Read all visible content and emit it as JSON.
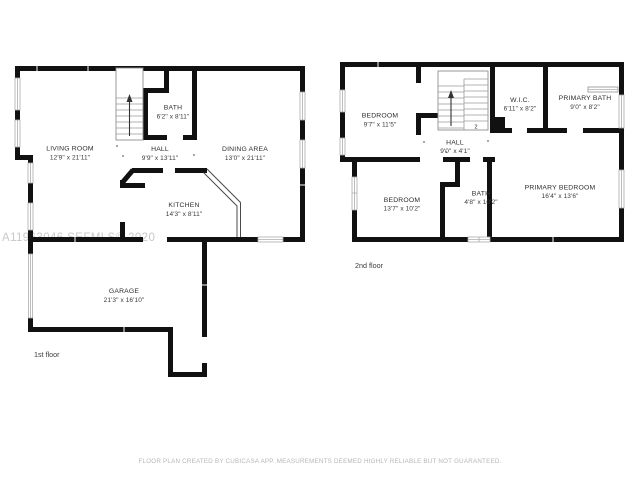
{
  "watermark": "A11963046 SEFMLS© 2020",
  "disclaimer": "FLOOR PLAN CREATED BY CUBICASA APP. MEASUREMENTS DEEMED HIGHLY RELIABLE BUT NOT GUARANTEED.",
  "stair_marker": "2",
  "colors": {
    "wall": "#111111",
    "window_frame": "#ababab",
    "watermark_text": "#c8c8c8",
    "fine_print": "#b6b6b6"
  },
  "floors": [
    {
      "label": "1st floor",
      "rooms": [
        {
          "name": "LIVING ROOM",
          "dims": "12'9\" x 21'11\""
        },
        {
          "name": "BATH",
          "dims": "6'2\" x 8'11\""
        },
        {
          "name": "HALL",
          "dims": "9'9\" x 13'11\""
        },
        {
          "name": "DINING AREA",
          "dims": "13'0\" x 21'11\""
        },
        {
          "name": "KITCHEN",
          "dims": "14'3\" x 8'11\""
        },
        {
          "name": "GARAGE",
          "dims": "21'3\" x 16'10\""
        }
      ]
    },
    {
      "label": "2nd floor",
      "rooms": [
        {
          "name": "BEDROOM",
          "dims": "9'7\" x 11'5\""
        },
        {
          "name": "W.I.C.",
          "dims": "6'11\" x 8'2\""
        },
        {
          "name": "PRIMARY BATH",
          "dims": "9'0\" x 8'2\""
        },
        {
          "name": "HALL",
          "dims": "9'0\" x 4'1\""
        },
        {
          "name": "BEDROOM",
          "dims": "13'7\" x 10'2\""
        },
        {
          "name": "BATH",
          "dims": "4'8\" x 10'2\""
        },
        {
          "name": "PRIMARY BEDROOM",
          "dims": "16'4\" x 13'6\""
        }
      ]
    }
  ]
}
